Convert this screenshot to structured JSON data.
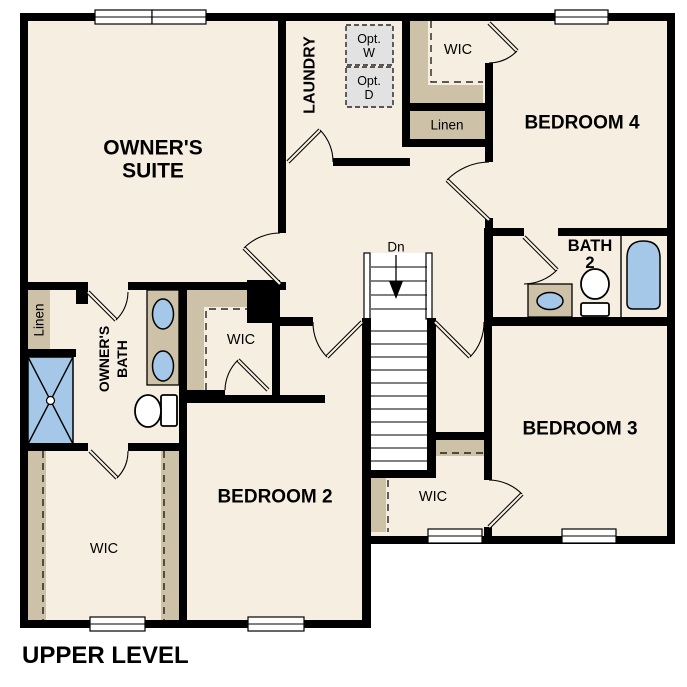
{
  "title": "UPPER LEVEL",
  "colors": {
    "background": "#ffffff",
    "floor": "#f6eee1",
    "wall": "#000000",
    "closet": "#cdc1a8",
    "fixture_blue": "#a6c8e8",
    "appliance": "#e2e2e2"
  },
  "rooms": {
    "owners_suite": {
      "line1": "OWNER'S",
      "line2": "SUITE"
    },
    "laundry": "LAUNDRY",
    "wic_bedroom4": "WIC",
    "linen_upper": "Linen",
    "bedroom4": "BEDROOM 4",
    "bath2": {
      "line1": "BATH",
      "line2": "2"
    },
    "bedroom3": "BEDROOM 3",
    "wic_bedroom3": "WIC",
    "bedroom2": "BEDROOM 2",
    "wic_owners": "WIC",
    "owners_bath": {
      "line1": "OWNER'S",
      "line2": "BATH"
    },
    "linen_owners": "Linen",
    "wic_hall": "WIC"
  },
  "stairs": {
    "direction_label": "Dn"
  },
  "appliances": {
    "washer": {
      "line1": "Opt.",
      "line2": "W"
    },
    "dryer": {
      "line1": "Opt.",
      "line2": "D"
    }
  }
}
